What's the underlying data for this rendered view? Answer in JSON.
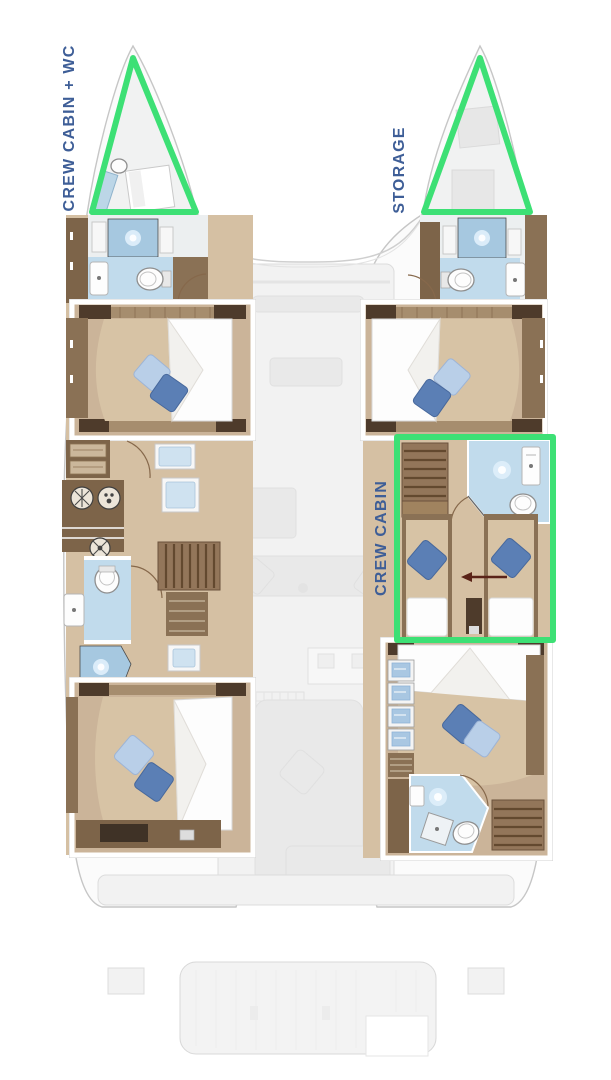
{
  "floorplan": {
    "type": "catamaran-lower-deck",
    "annotations": [
      {
        "id": "port-bow",
        "label": "CREW CABIN + WC"
      },
      {
        "id": "starboard-bow",
        "label": "STORAGE"
      },
      {
        "id": "starboard-midship",
        "label": "CREW CABIN"
      }
    ],
    "colors": {
      "highlight_green": "#3de075",
      "label_blue": "#3e5e97",
      "wood_floor": "#d5c0a3",
      "cabin_floor": "#cbb499",
      "bed_base": "#d7c3a5",
      "mattress": "#fdfdfd",
      "slat_wood": "#a68d6e",
      "dark_cabinet": "#4e3b2b",
      "brown_panel": "#7d6449",
      "mid_wood": "#8a7155",
      "stair_wood": "#93765a",
      "bath_floor": "#c1dbec",
      "shower_blue": "#a6c8e0",
      "pillow_dark": "#5b7fb5",
      "pillow_light": "#b9cfe8",
      "arrow_brown": "#5a2318",
      "hull_fill": "#fbfbfb",
      "hull_stroke": "#c6c6c6",
      "ghost_fill": "#f2f2f2",
      "ghost_stroke": "#dcdcdc",
      "ghost_furniture": "#e9e9e9"
    }
  }
}
